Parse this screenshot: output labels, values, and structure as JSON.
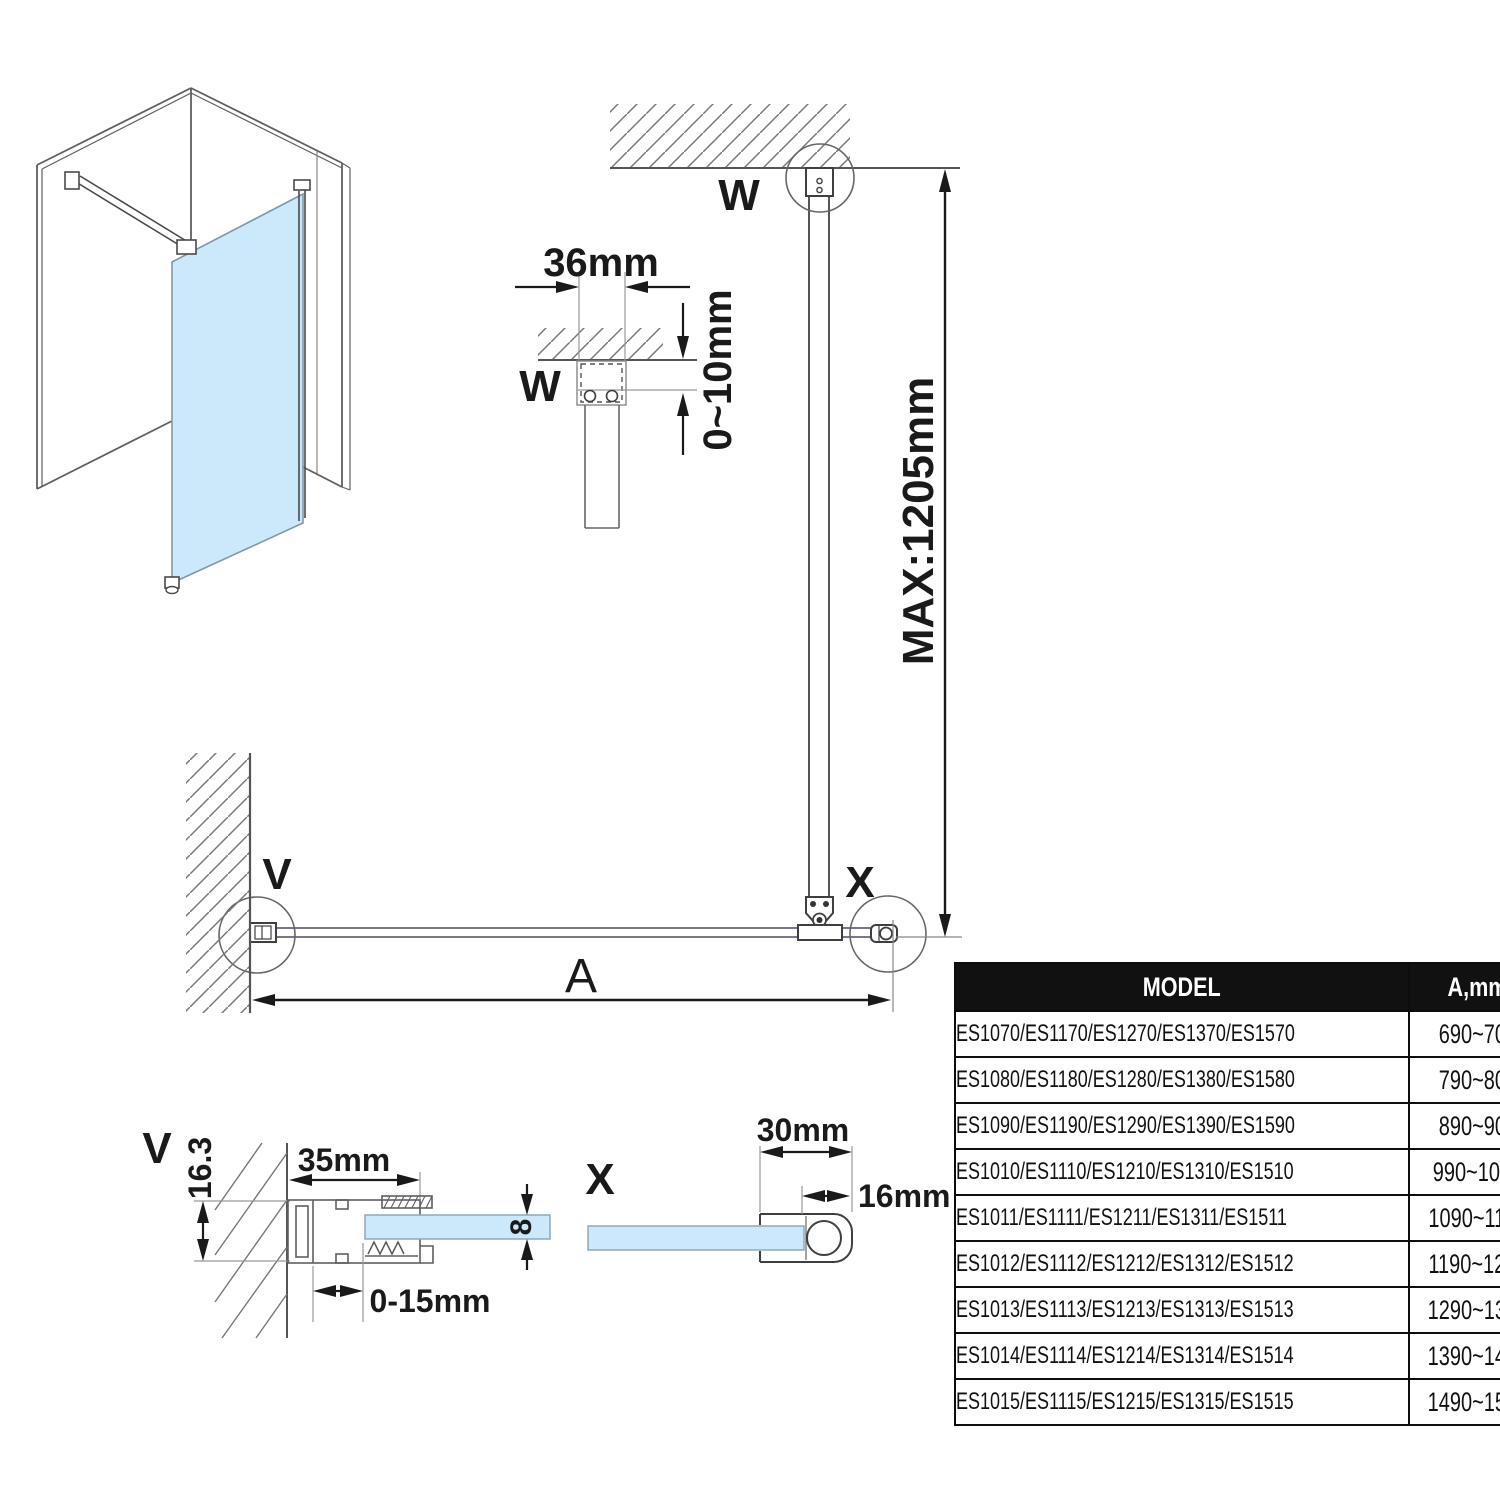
{
  "diagram": {
    "labels": {
      "w_main": "W",
      "w_detail": "W",
      "v_main": "V",
      "v_detail": "V",
      "x_main": "X",
      "x_detail": "X"
    },
    "dims": {
      "bracket_width": "36mm",
      "ceiling_gap": "0~10mm",
      "max_height": "MAX:1205mm",
      "width_a": "A",
      "wall_profile_width": "35mm",
      "wall_profile_depth": "16.3",
      "wall_adjust": "0-15mm",
      "glass_thickness": "8",
      "end_profile_width": "30mm",
      "end_profile_tube": "16mm"
    }
  },
  "table": {
    "headers": [
      "MODEL",
      "A,mm"
    ],
    "rows": [
      {
        "model": "ES1070/ES1170/ES1270/ES1370/ES1570",
        "a": "690~705"
      },
      {
        "model": "ES1080/ES1180/ES1280/ES1380/ES1580",
        "a": "790~805"
      },
      {
        "model": "ES1090/ES1190/ES1290/ES1390/ES1590",
        "a": "890~905"
      },
      {
        "model": "ES1010/ES1110/ES1210/ES1310/ES1510",
        "a": "990~1005"
      },
      {
        "model": "ES1011/ES1111/ES1211/ES1311/ES1511",
        "a": "1090~1105"
      },
      {
        "model": "ES1012/ES1112/ES1212/ES1312/ES1512",
        "a": "1190~1205"
      },
      {
        "model": "ES1013/ES1113/ES1213/ES1313/ES1513",
        "a": "1290~1305"
      },
      {
        "model": "ES1014/ES1114/ES1214/ES1314/ES1514",
        "a": "1390~1405"
      },
      {
        "model": "ES1015/ES1115/ES1215/ES1315/ES1515",
        "a": "1490~1505"
      }
    ]
  },
  "colors": {
    "glass": "#cbe9fa",
    "structure_line": "#5f5f5f",
    "dimension_line": "#1a1a1a",
    "table_header_bg": "#111111",
    "table_header_text": "#ffffff"
  }
}
